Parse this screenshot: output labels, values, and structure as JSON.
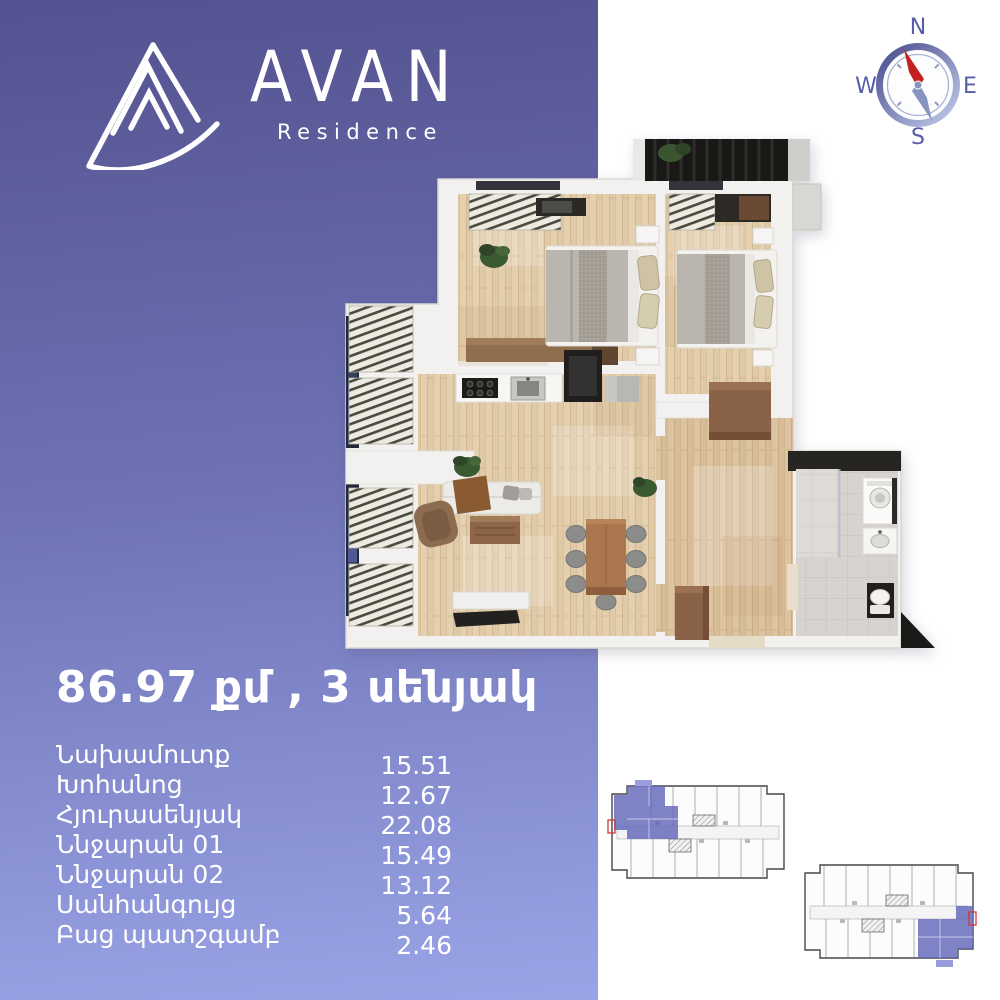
{
  "brand": {
    "name": "AVAN",
    "subtitle": "Residence"
  },
  "compass": {
    "n": "N",
    "w": "W",
    "e": "E",
    "s": "S"
  },
  "listing": {
    "title": "86.97 քմ , 3 սենյակ"
  },
  "rooms": [
    {
      "name": "Նախամուտք",
      "area": "15.51"
    },
    {
      "name": "Խոհանոց",
      "area": "12.67"
    },
    {
      "name": "Հյուրասենյակ",
      "area": "22.08"
    },
    {
      "name": "Ննջարան 01",
      "area": "15.49"
    },
    {
      "name": "Ննջարան 02",
      "area": "13.12"
    },
    {
      "name": "Սանհանգույց",
      "area": "5.64"
    },
    {
      "name": "Բաց պատշգամբ",
      "area": "2.46"
    }
  ],
  "colors": {
    "purple_top": "#545290",
    "purple_bottom": "#99a4e7",
    "text": "#ffffff",
    "compass_letters": "#575da8",
    "compass_needle_red": "#c32020",
    "compass_needle_tail": "#8794bf",
    "plan_highlight": "#6168ba",
    "plan_door_marker": "#cf3a3a",
    "wood_floor": "#dfc9a7",
    "slab_white": "#f2f1ef"
  }
}
